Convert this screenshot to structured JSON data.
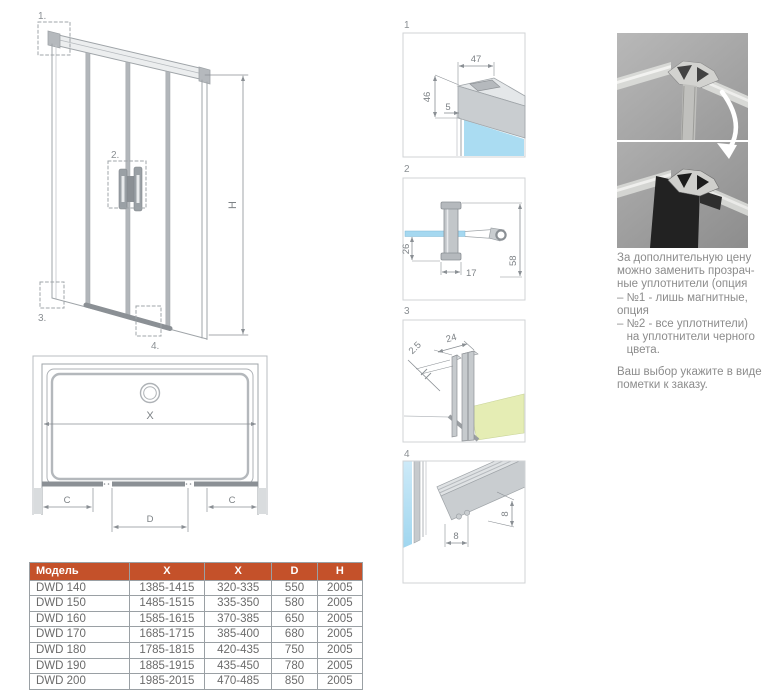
{
  "main_view": {
    "callout1": "1.",
    "callout2": "2.",
    "callout3": "3.",
    "callout4": "4.",
    "height_label": "H"
  },
  "top_view": {
    "width_label": "X",
    "side_left_label": "C",
    "door_label": "D",
    "side_right_label": "C"
  },
  "details": [
    {
      "num": "1",
      "dim_width": "47",
      "dim_height": "46",
      "dim_glass": "5"
    },
    {
      "num": "2",
      "dim_offset": "26",
      "dim_base": "17",
      "dim_total": "58"
    },
    {
      "num": "3",
      "dim_width": "24",
      "dim_thickness": "2.5"
    },
    {
      "num": "4",
      "dim_width": "8",
      "dim_height": "8"
    }
  ],
  "note": {
    "para1": "За дополнительную цену\nможно заменить прозрач-\nные уплотнители (опция\n– №1 - лишь магнитные,\nопция\n– №2 - все уплотнители)\n   на уплотнители черного\n   цвета.",
    "para2": "Ваш выбор укажите в виде\nпометки к заказу."
  },
  "table": {
    "headers": [
      "Модель",
      "X",
      "X",
      "D",
      "H"
    ],
    "rows": [
      [
        "DWD 140",
        "1385-1415",
        "320-335",
        "550",
        "2005"
      ],
      [
        "DWD 150",
        "1485-1515",
        "335-350",
        "580",
        "2005"
      ],
      [
        "DWD 160",
        "1585-1615",
        "370-385",
        "650",
        "2005"
      ],
      [
        "DWD 170",
        "1685-1715",
        "385-400",
        "680",
        "2005"
      ],
      [
        "DWD 180",
        "1785-1815",
        "420-435",
        "750",
        "2005"
      ],
      [
        "DWD 190",
        "1885-1915",
        "435-450",
        "780",
        "2005"
      ],
      [
        "DWD 200",
        "1985-2015",
        "470-485",
        "850",
        "2005"
      ]
    ]
  },
  "colors": {
    "accent": "#c4512a",
    "glass": "#aadcf2",
    "floor": "#e5edb4"
  }
}
